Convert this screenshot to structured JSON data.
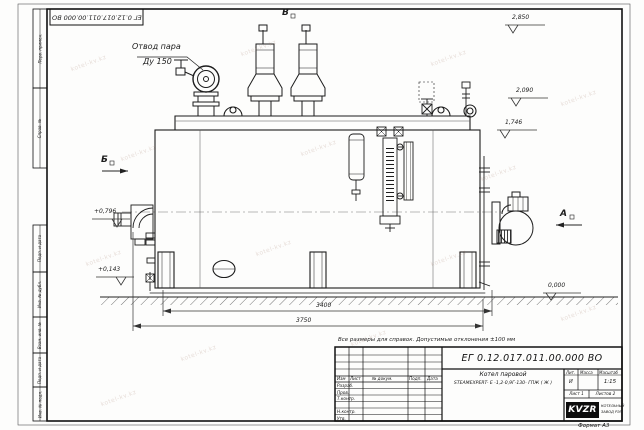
{
  "watermark": {
    "text": "kotel-kv.kz"
  },
  "frame": {
    "top_code": "ЕГ 0.12.017.011.00.000  ВО",
    "strip": {
      "perv": "Перв. примен.",
      "sprav": "Справ. №",
      "podp1": "Подп. и дата",
      "inv_dubl": "Инв. № дубл.",
      "vzam": "Взам. инв. №",
      "podp2": "Подп. и дата",
      "inv_podl": "Инв. № подл."
    },
    "format_note": "Формат А3"
  },
  "drawing": {
    "labels": {
      "steam1": "Отвод пара",
      "steam2": "Ду 150",
      "view_v": "В",
      "view_b": "Б",
      "view_a": "А"
    },
    "elevations": {
      "e2850": "2,850",
      "e2090": "2,090",
      "e1746": "1,746",
      "e0796": "+0,796",
      "e0143": "+0,143",
      "e0000": "0,000"
    },
    "dims": {
      "len_inner": "3400",
      "len_outer": "3750"
    }
  },
  "note": "Все размеры для справок. Допустимые отклонения ±100 мм",
  "title_block": {
    "doc_number": "ЕГ 0.12.017.011.00.000  ВО",
    "header": {
      "izm": "Изм",
      "list": "Лист",
      "ndocum": "№ докум.",
      "podp": "Подп.",
      "data": "Дата"
    },
    "rows": {
      "razrab": "Разраб.",
      "prov": "Пров.",
      "tkontr": "Т.контр.",
      "nkontr": "Н.контр.",
      "utv": "Утв."
    },
    "name_line1": "Котел паровой",
    "name_line2": "STEAMEXPERT- Е -1,2-0,9Г-130- ГПЖ ( Ж )",
    "lit_header": "Лит.",
    "lit_value": "И",
    "mass_header": "Масса",
    "scale_header": "Масштаб",
    "scale_value": "1:15",
    "sheet": "Лист 1",
    "sheets": "Листов 2",
    "logo_text": "KVZR",
    "company_line1": "КОТЕЛЬНЫЙ",
    "company_line2": "ЗАВОД РЭП"
  }
}
